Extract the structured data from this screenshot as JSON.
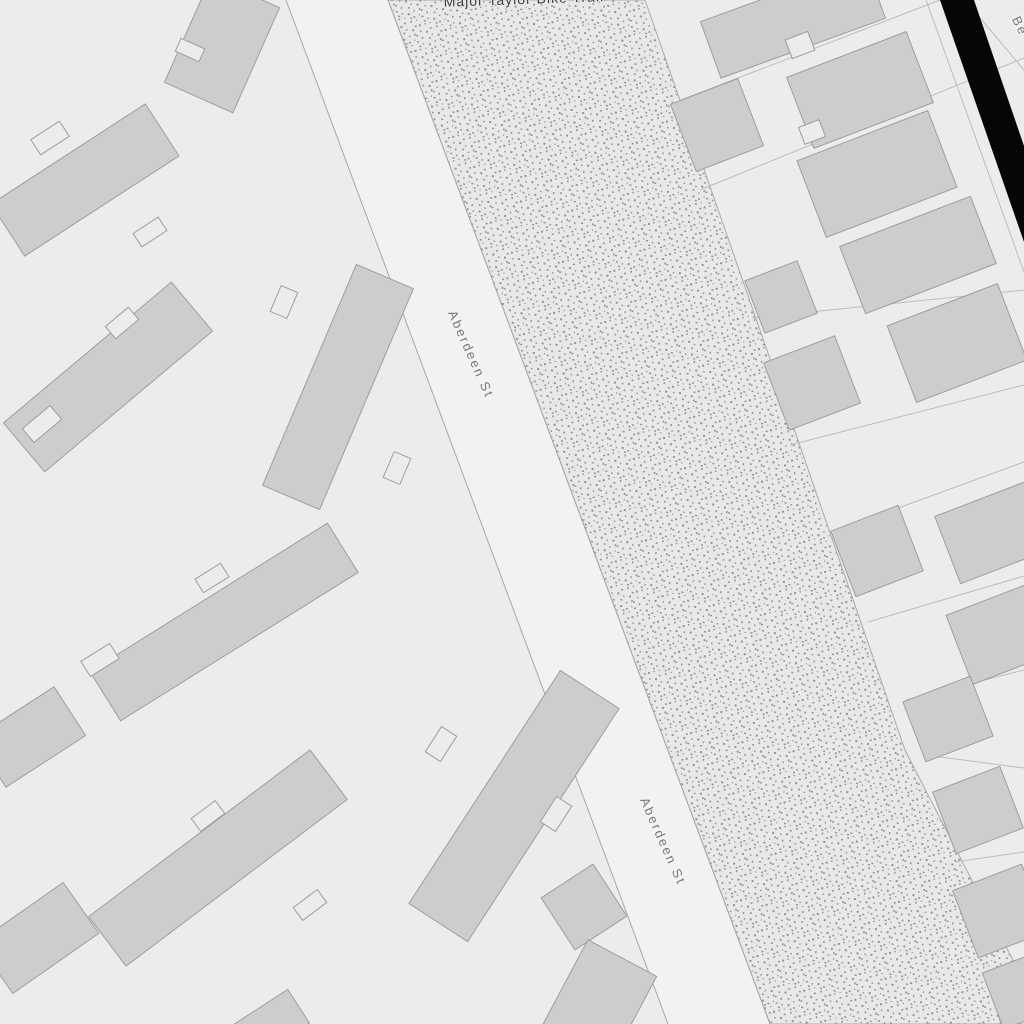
{
  "map": {
    "view": "street-map-tile",
    "street_name": "Aberdeen St",
    "trail_name": "Major Taylor Bike Trail",
    "partial_street_name_top_right": "Be",
    "colors": {
      "background": "#ececec",
      "street_fill": "#f2f2f2",
      "street_casing": "#a8a8a8",
      "building_fill": "#cdcdcd",
      "building_stroke": "#9e9e9e",
      "stipple_fill": "#e8e8e8",
      "stipple_dot": "#949494",
      "stipple_border": "#ababab",
      "parcel_line": "#bdbdbd",
      "railway_band": "#060606",
      "street_label_color": "#757575",
      "trail_label_color": "#3f3f3f",
      "label_halo": "#f5f5f5"
    },
    "labels": [
      {
        "name": "aberdeen-street-label-upper",
        "text": "Aberdeen St",
        "transform": "translate(467,356) rotate(66)",
        "class": "street-label"
      },
      {
        "name": "aberdeen-street-label-lower",
        "text": "Aberdeen St",
        "transform": "translate(659,843) rotate(66)",
        "class": "street-label"
      },
      {
        "name": "trail-label-top-cutoff",
        "text": "Major Taylor Bike Trail",
        "transform": "translate(524,4) rotate(-2)",
        "class": "trail-label"
      },
      {
        "name": "partial-street-label-top-right",
        "text": "Be",
        "transform": "translate(1016,28) rotate(64)",
        "class": "street-label"
      }
    ],
    "geometry": {
      "street_polygon": "286,0 388,0 770,1024 668,1024",
      "street_casing_lines": [
        [
          286,
          0,
          668,
          1024
        ],
        [
          388,
          0,
          770,
          1024
        ]
      ],
      "stipple_polygon": "388,0 645,0 760,330 905,750 1018,970 1042,1024 770,1024",
      "railway_band_polygon": "940,0 974,0 1024,146 1024,242",
      "parcel_lines": [
        [
          681,
          100,
          940,
          0
        ],
        [
          700,
          190,
          1024,
          58
        ],
        [
          752,
          318,
          1024,
          290
        ],
        [
          790,
          445,
          1024,
          385
        ],
        [
          838,
          530,
          1024,
          462
        ],
        [
          868,
          622,
          1024,
          576
        ],
        [
          906,
          700,
          1024,
          670
        ],
        [
          925,
          755,
          1024,
          768
        ],
        [
          955,
          862,
          1024,
          852
        ],
        [
          995,
          985,
          1024,
          982
        ],
        [
          926,
          0,
          1024,
          272
        ],
        [
          965,
          0,
          1024,
          70
        ]
      ],
      "buildings": [
        {
          "cx": 222,
          "cy": 45,
          "w": 75,
          "h": 115,
          "a": 24
        },
        {
          "cx": 85,
          "cy": 180,
          "w": 184,
          "h": 62,
          "a": -33
        },
        {
          "cx": 108,
          "cy": 377,
          "w": 219,
          "h": 64,
          "a": -40
        },
        {
          "cx": 338,
          "cy": 387,
          "w": 62,
          "h": 240,
          "a": 23
        },
        {
          "cx": 224,
          "cy": 622,
          "w": 280,
          "h": 58,
          "a": -32
        },
        {
          "cx": 30,
          "cy": 737,
          "w": 95,
          "h": 58,
          "a": -33
        },
        {
          "cx": 218,
          "cy": 858,
          "w": 277,
          "h": 62,
          "a": -37
        },
        {
          "cx": 38,
          "cy": 938,
          "w": 105,
          "h": 62,
          "a": -35
        },
        {
          "cx": 514,
          "cy": 806,
          "w": 70,
          "h": 278,
          "a": 33
        },
        {
          "cx": 584,
          "cy": 907,
          "w": 62,
          "h": 62,
          "a": -33
        },
        {
          "cx": 600,
          "cy": 1000,
          "w": 78,
          "h": 95,
          "a": 28
        },
        {
          "cx": 265,
          "cy": 1028,
          "w": 80,
          "h": 40,
          "a": -33
        },
        {
          "cx": 793,
          "cy": 20,
          "w": 175,
          "h": 60,
          "a": -20
        },
        {
          "cx": 860,
          "cy": 90,
          "w": 128,
          "h": 76,
          "a": -21
        },
        {
          "cx": 717,
          "cy": 125,
          "w": 72,
          "h": 72,
          "a": -21
        },
        {
          "cx": 877,
          "cy": 174,
          "w": 140,
          "h": 82,
          "a": -21
        },
        {
          "cx": 781,
          "cy": 297,
          "w": 56,
          "h": 56,
          "a": -21
        },
        {
          "cx": 918,
          "cy": 255,
          "w": 140,
          "h": 72,
          "a": -21
        },
        {
          "cx": 812,
          "cy": 383,
          "w": 76,
          "h": 72,
          "a": -21
        },
        {
          "cx": 957,
          "cy": 343,
          "w": 118,
          "h": 82,
          "a": -21
        },
        {
          "cx": 877,
          "cy": 551,
          "w": 72,
          "h": 70,
          "a": -21
        },
        {
          "cx": 1000,
          "cy": 530,
          "w": 112,
          "h": 72,
          "a": -21
        },
        {
          "cx": 1006,
          "cy": 632,
          "w": 100,
          "h": 74,
          "a": -21
        },
        {
          "cx": 948,
          "cy": 719,
          "w": 72,
          "h": 64,
          "a": -21
        },
        {
          "cx": 978,
          "cy": 810,
          "w": 72,
          "h": 66,
          "a": -21
        },
        {
          "cx": 1000,
          "cy": 911,
          "w": 74,
          "h": 72,
          "a": -21
        },
        {
          "cx": 1022,
          "cy": 990,
          "w": 62,
          "h": 60,
          "a": -21
        }
      ],
      "building_notches": [
        {
          "cx": 190,
          "cy": 50,
          "w": 26,
          "h": 14,
          "a": 24
        },
        {
          "cx": 50,
          "cy": 138,
          "w": 34,
          "h": 18,
          "a": -33
        },
        {
          "cx": 150,
          "cy": 232,
          "w": 30,
          "h": 16,
          "a": -33
        },
        {
          "cx": 42,
          "cy": 424,
          "w": 36,
          "h": 18,
          "a": -40
        },
        {
          "cx": 122,
          "cy": 323,
          "w": 30,
          "h": 16,
          "a": -40
        },
        {
          "cx": 284,
          "cy": 302,
          "w": 18,
          "h": 28,
          "a": 23
        },
        {
          "cx": 397,
          "cy": 468,
          "w": 18,
          "h": 28,
          "a": 23
        },
        {
          "cx": 212,
          "cy": 578,
          "w": 30,
          "h": 16,
          "a": -32
        },
        {
          "cx": 100,
          "cy": 660,
          "w": 34,
          "h": 18,
          "a": -32
        },
        {
          "cx": 208,
          "cy": 816,
          "w": 30,
          "h": 16,
          "a": -37
        },
        {
          "cx": 310,
          "cy": 905,
          "w": 30,
          "h": 16,
          "a": -37
        },
        {
          "cx": 441,
          "cy": 744,
          "w": 18,
          "h": 30,
          "a": 33
        },
        {
          "cx": 556,
          "cy": 814,
          "w": 18,
          "h": 30,
          "a": 33
        },
        {
          "cx": 800,
          "cy": 45,
          "w": 24,
          "h": 20,
          "a": -21
        },
        {
          "cx": 812,
          "cy": 132,
          "w": 22,
          "h": 18,
          "a": -21
        }
      ]
    }
  }
}
